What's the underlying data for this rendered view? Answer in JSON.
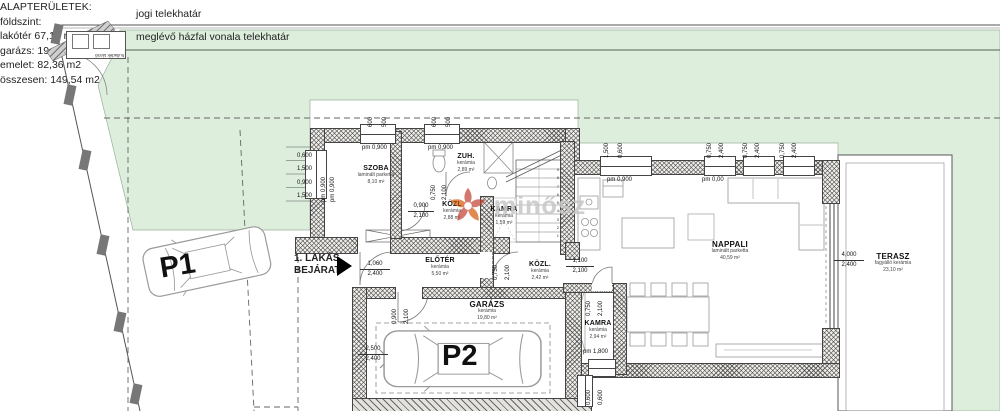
{
  "site": {
    "boundary_top_label": "jogi telekhatár",
    "boundary_strip_label": "meglévő házfal vonala telekhatár",
    "waste_label": "hulladék tároló"
  },
  "summary": {
    "title": "ALAPTERÜLETEK:",
    "lines": [
      "földszint:",
      "lakótér 67,18 m2",
      "garázs: 19,80 m2",
      "emelet: 82,36 m2",
      "összesen: 149,54 m2"
    ]
  },
  "entrance": {
    "line1": "1. LAKÁS",
    "line2": "BEJÁRAT"
  },
  "parking": {
    "p1": "P1",
    "p2": "P2"
  },
  "watermark": {
    "text": "minősz"
  },
  "stairs": {
    "numbers": "9\n8\n7\n6\n5\n4\n3\n2\n1"
  },
  "rooms": {
    "szoba": {
      "name": "SZOBA",
      "material": "laminált parketta",
      "area": "8,10 m²"
    },
    "zuh": {
      "name": "ZUH.",
      "material": "kerámia",
      "area": "2,89 m²"
    },
    "kozl1": {
      "name": "KÖZL",
      "material": "kerámia",
      "area": "2,88 m²"
    },
    "kamra1": {
      "name": "KAMRA",
      "material": "kerámia",
      "area": "1,59 m²"
    },
    "eloter": {
      "name": "ELŐTÉR",
      "material": "kerámia",
      "area": "5,50 m²"
    },
    "kozl2": {
      "name": "KÖZL.",
      "material": "kerámia",
      "area": "2,42 m²"
    },
    "garazs": {
      "name": "GARÁZS",
      "material": "kerámia",
      "area": "19,80 m²"
    },
    "kamra2": {
      "name": "KAMRA",
      "material": "kerámia",
      "area": "2,94 m²"
    },
    "nappali": {
      "name": "NAPPALI",
      "material": "laminált parketta",
      "area": "40,59 m²"
    },
    "terasz": {
      "name": "TERASZ",
      "material": "fagyálló kerámia",
      "area": "23,10 m²"
    }
  },
  "dims": {
    "w1a": "600",
    "w1b": "500",
    "w2a": "600",
    "w2b": "500",
    "left1": "0,600",
    "left2": "1,500",
    "left3": "0,900",
    "left4": "1,500",
    "pmLeft1": "pm 0,900",
    "pmLeft2": "pm 0,900",
    "pmSzoba1": "pm 0,900",
    "pmSzoba2": "pm 0,900",
    "zuhDoorA": "0,750",
    "zuhDoorB": "2,100",
    "szobaDoorA": "0,900",
    "szobaDoorB": "2,100",
    "entranceA": "1,060",
    "entranceB": "2,400",
    "garageDoorA": "0,900",
    "garageDoorB": "2,100",
    "garageA": "2,500",
    "garageB": "2,400",
    "kozl2DoorA": "0,750",
    "kozl2DoorB": "2,100",
    "nappaliDoorA": "1,100",
    "nappaliDoorB": "2,100",
    "kamraDoorA": "0,750",
    "kamraDoorB": "2,100",
    "pmKamra": "pm 1,800",
    "kamraWinA": "0,600",
    "kamraWinB": "0,600",
    "nWin1a": "1,500",
    "nWin1b": "0,600",
    "nWin2a": "0,750",
    "nWin2b": "2,400",
    "nWin3a": "0,750",
    "nWin3b": "2,400",
    "nWin4a": "0,750",
    "nWin4b": "2,400",
    "pmNappali1": "pm 0,900",
    "pmNappali2": "pm 0,00",
    "teraszA": "4,000",
    "teraszB": "2,400"
  },
  "colors": {
    "plot_green": "#ddeedd",
    "wall_gray": "#efede9",
    "accent_red": "#c0392b"
  }
}
